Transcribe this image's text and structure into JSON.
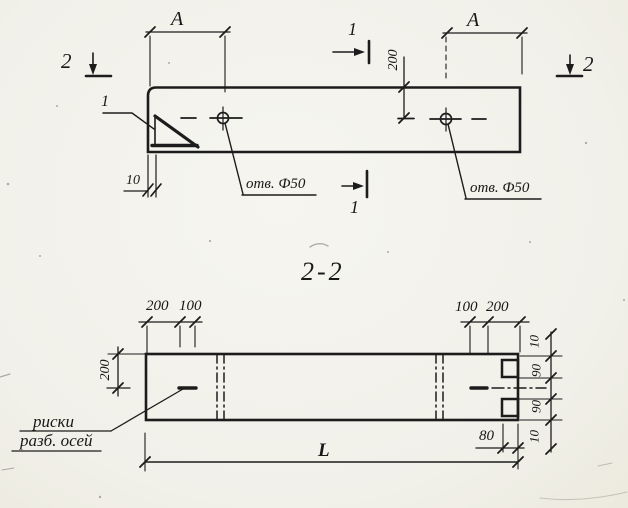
{
  "drawing": {
    "section_title": "2-2",
    "top_view": {
      "dim_a_left": "A",
      "dim_a_right": "A",
      "dim_200_vertical": "200",
      "dim_10": "10",
      "hole_label_left": "отв. Ф50",
      "hole_label_right": "отв. Ф50",
      "detail_callout": "1",
      "section_mark_1_top": "1",
      "section_mark_1_bottom": "1",
      "section_mark_2_left": "2",
      "section_mark_2_right": "2"
    },
    "section_view": {
      "dims_top_left": [
        "200",
        "100"
      ],
      "dims_top_right": [
        "100",
        "200"
      ],
      "dim_200_vertical": "200",
      "chain_right": [
        "10",
        "90",
        "90",
        "10"
      ],
      "dim_80": "80",
      "dim_length": "L",
      "axis_note_line1": "риски",
      "axis_note_line2": "разб. осей"
    },
    "colors": {
      "ink": "#1c1c1c",
      "paper": "#f1f0e9"
    }
  }
}
